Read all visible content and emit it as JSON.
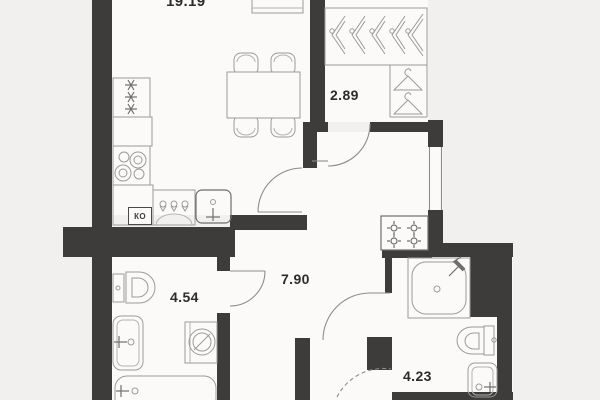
{
  "plan": {
    "title_note": "apartment floor plan",
    "rooms": {
      "living": {
        "area": "19.19"
      },
      "wardrobe": {
        "area": "2.89"
      },
      "hallway": {
        "area": "7.90"
      },
      "bathroom_left": {
        "area": "4.54"
      },
      "bathroom_right": {
        "area": "4.23"
      }
    },
    "kitchen_unit_label": "КО",
    "colors": {
      "background": "#f1f0ee",
      "floor": "#fbfaf9",
      "wall": "#3d3c3a",
      "fixture_line": "#9c9b99",
      "text": "#2d2c2a"
    },
    "icons": [
      "stove-burners-icon",
      "cooktop-star-icon",
      "kitchen-sink-icon",
      "dining-table",
      "chair",
      "hanger-side-icon",
      "hanger-front-icon",
      "toilet-icon",
      "washbasin-icon",
      "washing-machine-icon",
      "bathtub-icon",
      "shower-icon",
      "gas-burner-icon",
      "door-swing-arc"
    ]
  }
}
